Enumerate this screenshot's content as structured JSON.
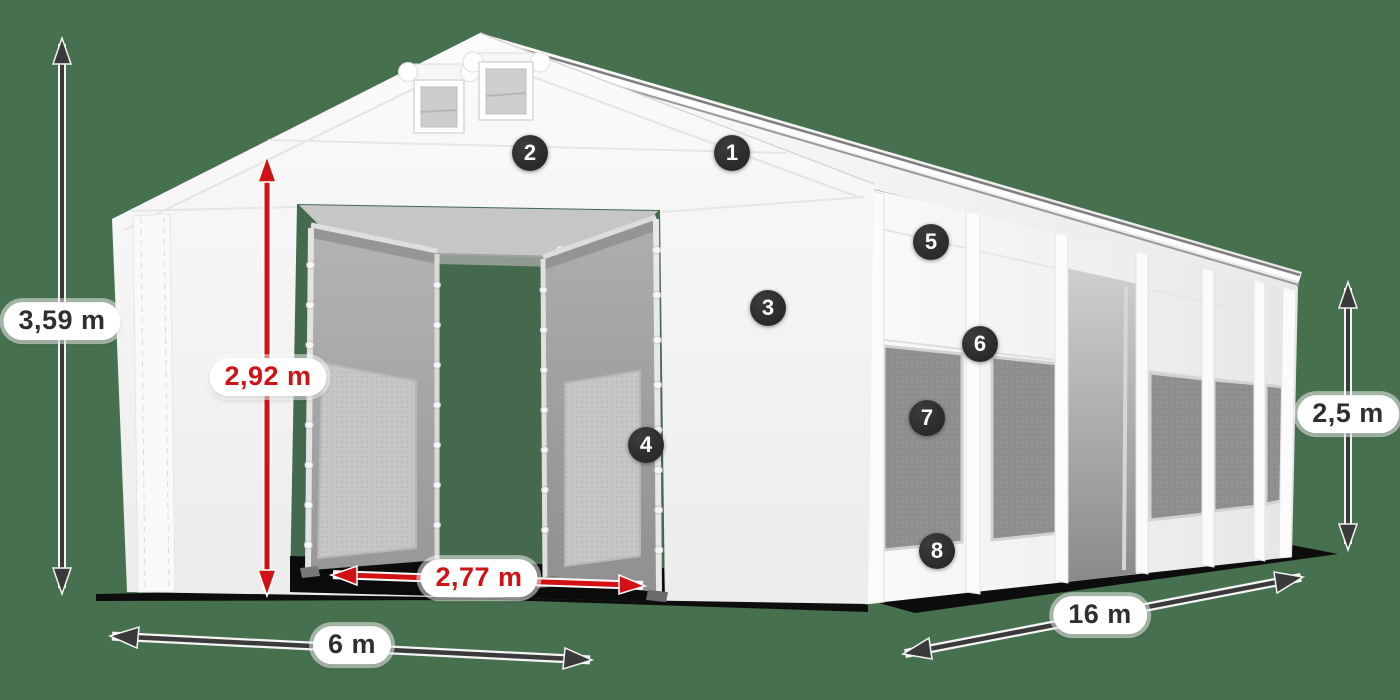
{
  "scene": {
    "background_color": "#47704F"
  },
  "colors": {
    "arrow_dark": "#3a3a3a",
    "arrow_red": "#d21114",
    "label_text_dark": "#2f2f2f",
    "label_text_red": "#ce1316",
    "marker_background": "#2a2a2a",
    "marker_text": "#ffffff",
    "tent_white": "#f4f4f4",
    "door_gray": "#a5a5a5",
    "mesh_window_gray": "#8e8e8e",
    "ground_shadow": "#0d0d0d"
  },
  "dimensions": [
    {
      "id": "total-height",
      "label": "3,59 m",
      "style": "dark"
    },
    {
      "id": "entrance-height",
      "label": "2,92 m",
      "style": "red"
    },
    {
      "id": "entrance-width",
      "label": "2,77 m",
      "style": "red"
    },
    {
      "id": "tent-width",
      "label": "6 m",
      "style": "dark"
    },
    {
      "id": "tent-length",
      "label": "16 m",
      "style": "dark"
    },
    {
      "id": "side-height",
      "label": "2,5 m",
      "style": "dark"
    }
  ],
  "markers": [
    {
      "label": "1"
    },
    {
      "label": "2"
    },
    {
      "label": "3"
    },
    {
      "label": "4"
    },
    {
      "label": "5"
    },
    {
      "label": "6"
    },
    {
      "label": "7"
    },
    {
      "label": "8"
    }
  ]
}
